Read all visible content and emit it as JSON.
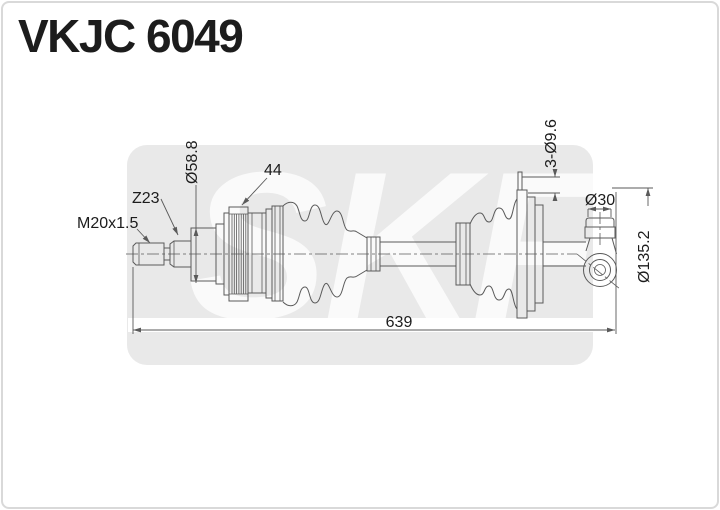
{
  "title": "VKJC 6049",
  "watermark": "SKF",
  "colors": {
    "background": "#ffffff",
    "border": "#d9d9d9",
    "panel": "#e9e9e9",
    "watermark": "#fafafa",
    "line": "#5a5a5a",
    "dimension": "#5a5a5a",
    "text": "#1c1c1c"
  },
  "drawing": {
    "dimensions": {
      "thread_spec": "M20x1.5",
      "spline_teeth": "Z23",
      "seat_diameter": "Ø58.8",
      "abs_ring_teeth": "44",
      "bolt_holes": "3-Ø9.6",
      "stub_diameter": "Ø30",
      "flange_diameter": "Ø135.2",
      "total_length": "639"
    }
  }
}
